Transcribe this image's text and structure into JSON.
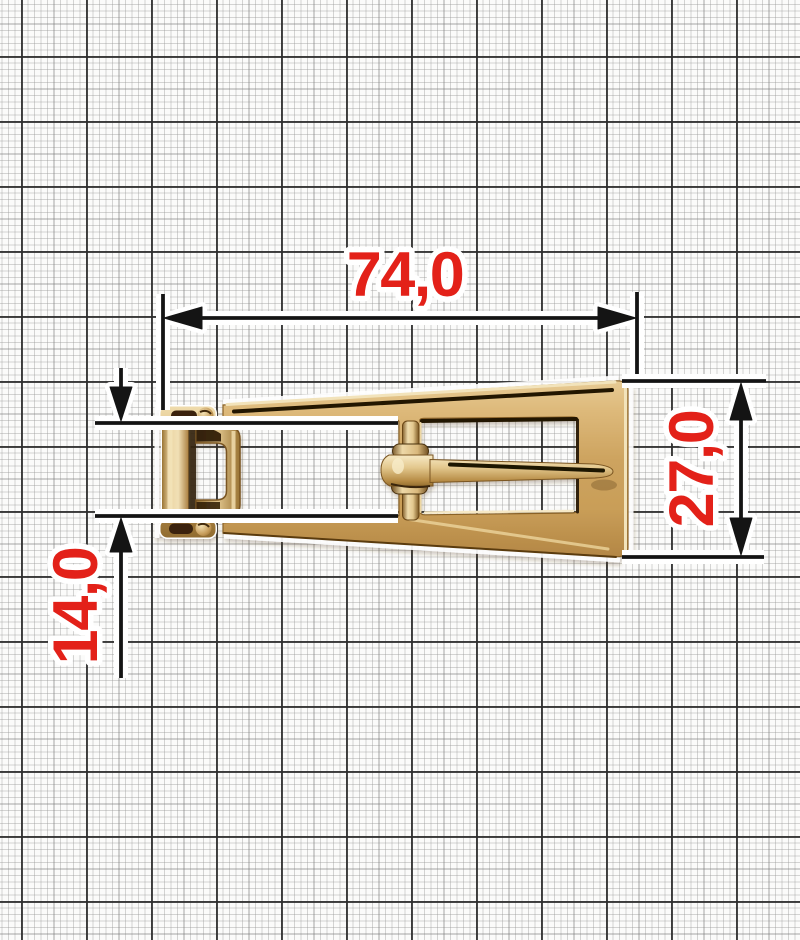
{
  "figure": {
    "subject": "gold metal strap buckle photographed on millimeter graph paper",
    "labels": {
      "width": "74,0",
      "height": "27,0",
      "loop_height": "14,0"
    },
    "colors": {
      "dimension_label": "#e32119",
      "dimension_line": "#141414",
      "halo": "#ffffff",
      "gold_base": "#cfa55f",
      "gold_highlight": "#f2e3bb",
      "gold_shadow": "#7a5520",
      "paper": "#fbfbfa",
      "grid_fine": "#bfbfbf",
      "grid_bold": "#3d3d3d"
    }
  }
}
